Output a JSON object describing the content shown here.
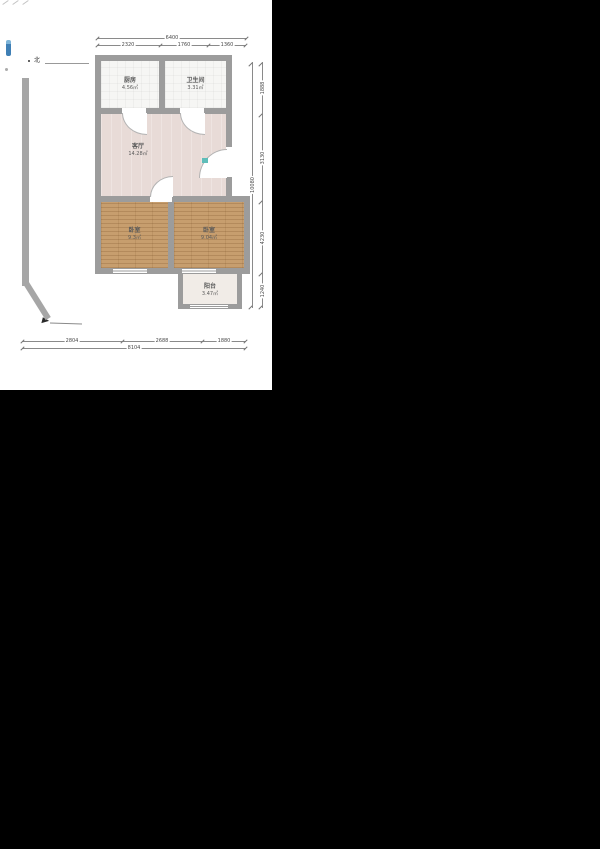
{
  "compass": {
    "north_label": "北"
  },
  "rooms": [
    {
      "name": "厨房",
      "area": "4.56㎡"
    },
    {
      "name": "卫生间",
      "area": "3.31㎡"
    },
    {
      "name": "客厅",
      "area": "14.28㎡"
    },
    {
      "name": "卧室",
      "area": "9.3㎡"
    },
    {
      "name": "卧室",
      "area": "9.04㎡"
    },
    {
      "name": "阳台",
      "area": "3.47㎡"
    }
  ],
  "dimensions": {
    "top": {
      "total": "6400",
      "segments": [
        "2320",
        "1760",
        "1360"
      ]
    },
    "right": {
      "total": "10080",
      "segments": [
        "1888",
        "3130",
        "4230",
        "1240"
      ]
    },
    "bottom": {
      "total": "8104",
      "segments": [
        "2804",
        "2688",
        "1880"
      ]
    }
  },
  "colors": {
    "canvas": "#ffffff",
    "outside": "#000000",
    "wall": "#9c9c9c",
    "living_floor": "#e8dbd7",
    "wood_floor": "#c79e6e",
    "tile_floor": "#f6f6f4",
    "balcony_floor": "#f1ece7",
    "accent_teal": "#5fbdb9"
  }
}
